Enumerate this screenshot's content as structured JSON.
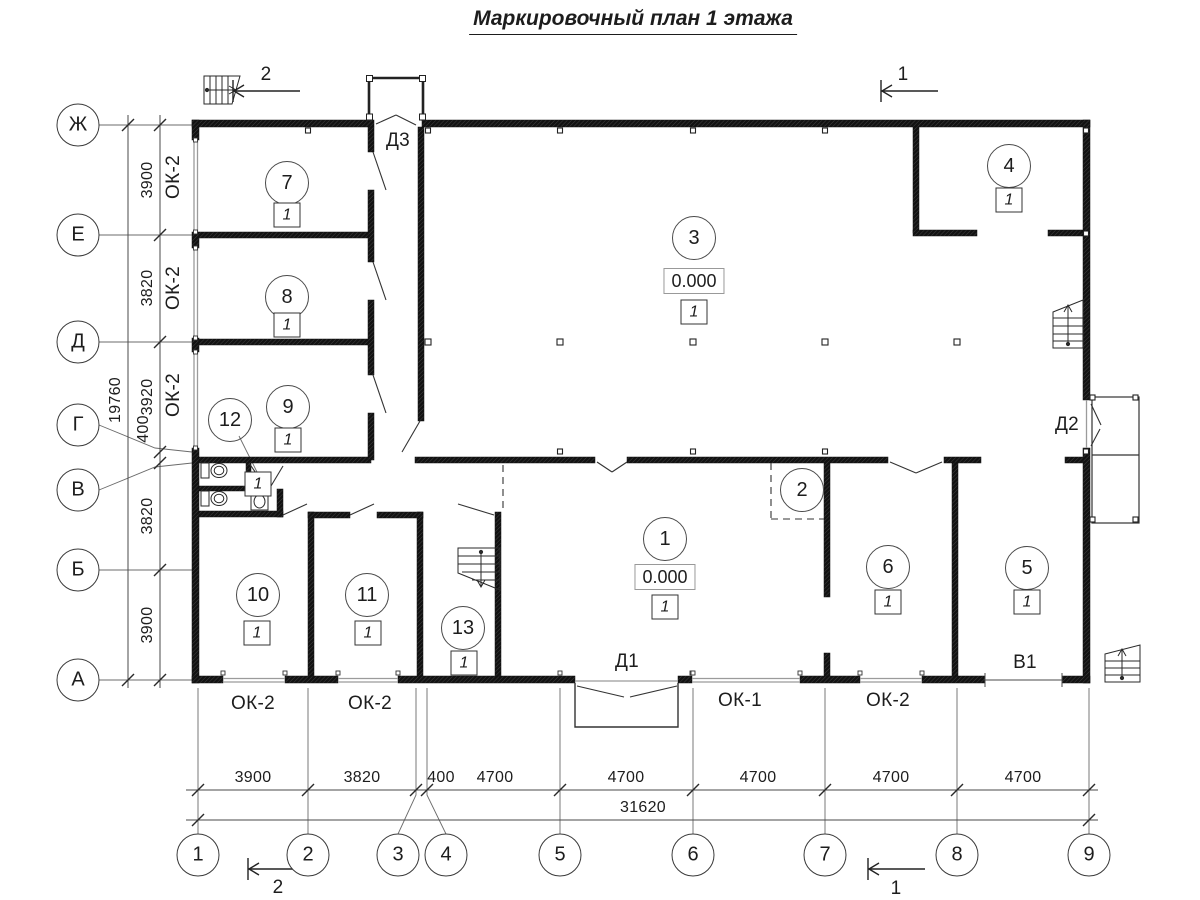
{
  "title": "Маркировочный план 1 этажа",
  "axes": {
    "rows": [
      "Ж",
      "Е",
      "Д",
      "Г",
      "В",
      "Б",
      "А"
    ],
    "cols": [
      "1",
      "2",
      "3",
      "4",
      "5",
      "6",
      "7",
      "8",
      "9"
    ]
  },
  "dimensions": {
    "left": [
      "3900",
      "3820",
      "3920",
      "400",
      "3820",
      "3900"
    ],
    "left_total": "19760",
    "bottom": [
      "3900",
      "3820",
      "400",
      "4700",
      "4700",
      "4700",
      "4700",
      "4700"
    ],
    "bottom_total": "31620"
  },
  "rooms": [
    {
      "number": "1",
      "floor": "1",
      "elevation": "0.000"
    },
    {
      "number": "2"
    },
    {
      "number": "3",
      "floor": "1",
      "elevation": "0.000"
    },
    {
      "number": "4",
      "floor": "1"
    },
    {
      "number": "5",
      "floor": "1"
    },
    {
      "number": "6",
      "floor": "1"
    },
    {
      "number": "7",
      "floor": "1"
    },
    {
      "number": "8",
      "floor": "1"
    },
    {
      "number": "9",
      "floor": "1"
    },
    {
      "number": "10",
      "floor": "1"
    },
    {
      "number": "11",
      "floor": "1"
    },
    {
      "number": "12",
      "floor": "1"
    },
    {
      "number": "13",
      "floor": "1"
    }
  ],
  "openings": {
    "doors": {
      "d1": "Д1",
      "d2": "Д2",
      "d3": "Д3"
    },
    "gate": "В1",
    "windows_left": [
      "ОК-2",
      "ОК-2",
      "ОК-2"
    ],
    "windows_bottom": [
      "ОК-2",
      "ОК-2",
      "ОК-1",
      "ОК-2"
    ]
  },
  "sections": {
    "one": "1",
    "two": "2"
  },
  "colors": {
    "line": "#222222",
    "thin": "#555555",
    "window": "#9b9b9b",
    "paper": "#ffffff"
  }
}
